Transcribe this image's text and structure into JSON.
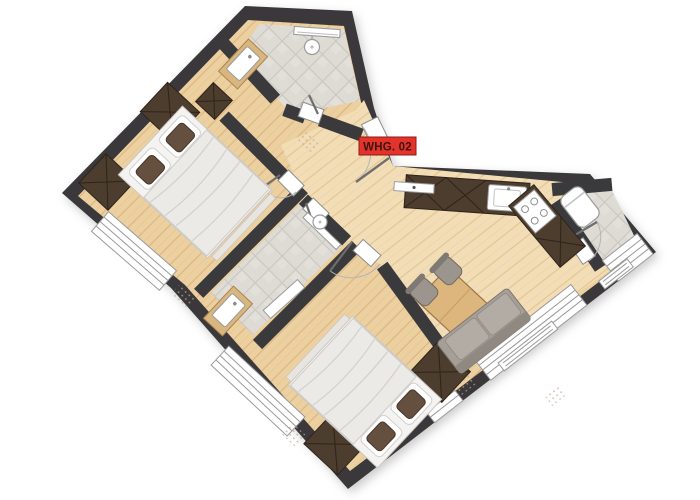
{
  "label": {
    "text": "WHG. 02"
  },
  "palette": {
    "wall": "#3a393b",
    "wood": "#ecd0a0",
    "wood_light": "#f2ddb6",
    "wood_line": "#d8b27c",
    "tile": "#dedbd5",
    "cabinet": "#4c3d2e",
    "accent_red": "#e2342b",
    "label_text": "#3f1410",
    "window": "#ffffff",
    "sofa": "#a59f97",
    "bed": "#f4f3f1",
    "background": "#ffffff"
  }
}
